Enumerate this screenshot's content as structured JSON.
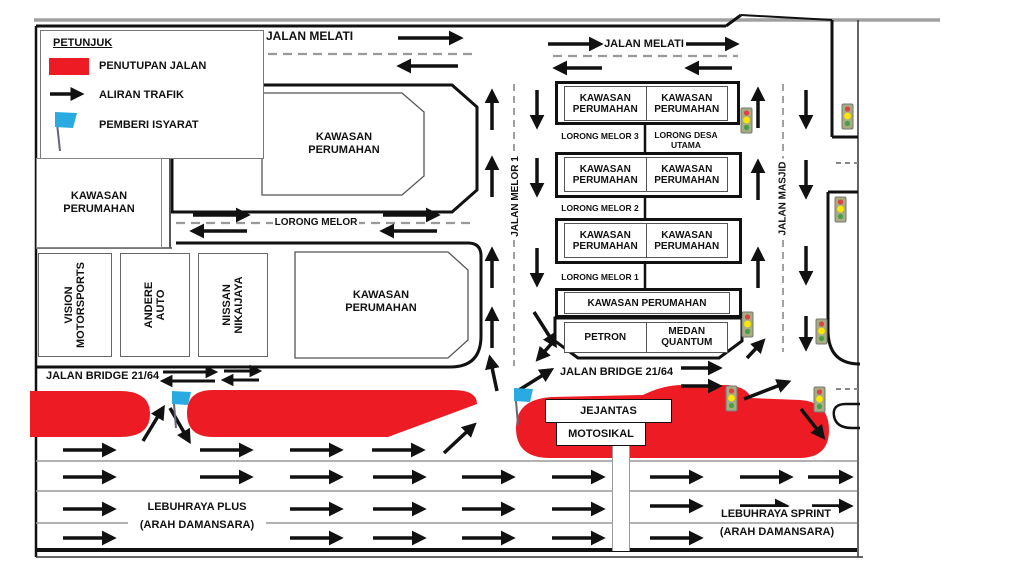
{
  "diagram": {
    "legend": {
      "title": "PETUNJUK",
      "items": [
        {
          "icon": "road-closure-swatch",
          "label": "PENUTUPAN JALAN"
        },
        {
          "icon": "traffic-flow-arrow",
          "label": "ALIRAN TRAFIK"
        },
        {
          "icon": "signal-flag",
          "label": "PEMBERI ISYARAT"
        }
      ]
    },
    "roads": {
      "jalan_melati": "JALAN MELATI",
      "lorong_melor": "LORONG MELOR",
      "jalan_melor_1": "JALAN MELOR 1",
      "jalan_masjid": "JALAN MASJID",
      "lorong_melor_3": "LORONG MELOR 3",
      "lorong_desa_utama": "LORONG DESA UTAMA",
      "lorong_melor_2": "LORONG MELOR 2",
      "lorong_melor_1": "LORONG MELOR 1",
      "jalan_bridge": "JALAN BRIDGE 21/64",
      "lebuhraya_plus": "LEBUHRAYA PLUS",
      "lebuhraya_sprint": "LEBUHRAYA SPRINT",
      "arah_damansara": "(ARAH DAMANSARA)"
    },
    "areas": {
      "kawasan_perumahan": "KAWASAN PERUMAHAN",
      "petron": "PETRON",
      "medan_quantum": "MEDAN QUANTUM",
      "jejantas": "JEJANTAS",
      "motosikal": "MOTOSIKAL"
    },
    "businesses": [
      {
        "label": "VISION MOTORSPORTS"
      },
      {
        "label": "ANDERE AUTO"
      },
      {
        "label": "NISSAN NIKAIJAYA"
      }
    ],
    "colors": {
      "closure_red": "#ed1c24",
      "flag_blue": "#29abe2",
      "traffic_light_red": "#e04048",
      "traffic_light_yellow": "#ffe600",
      "traffic_light_green": "#4a9e4a",
      "line_black": "#111111",
      "lane_gray": "#999999"
    }
  }
}
